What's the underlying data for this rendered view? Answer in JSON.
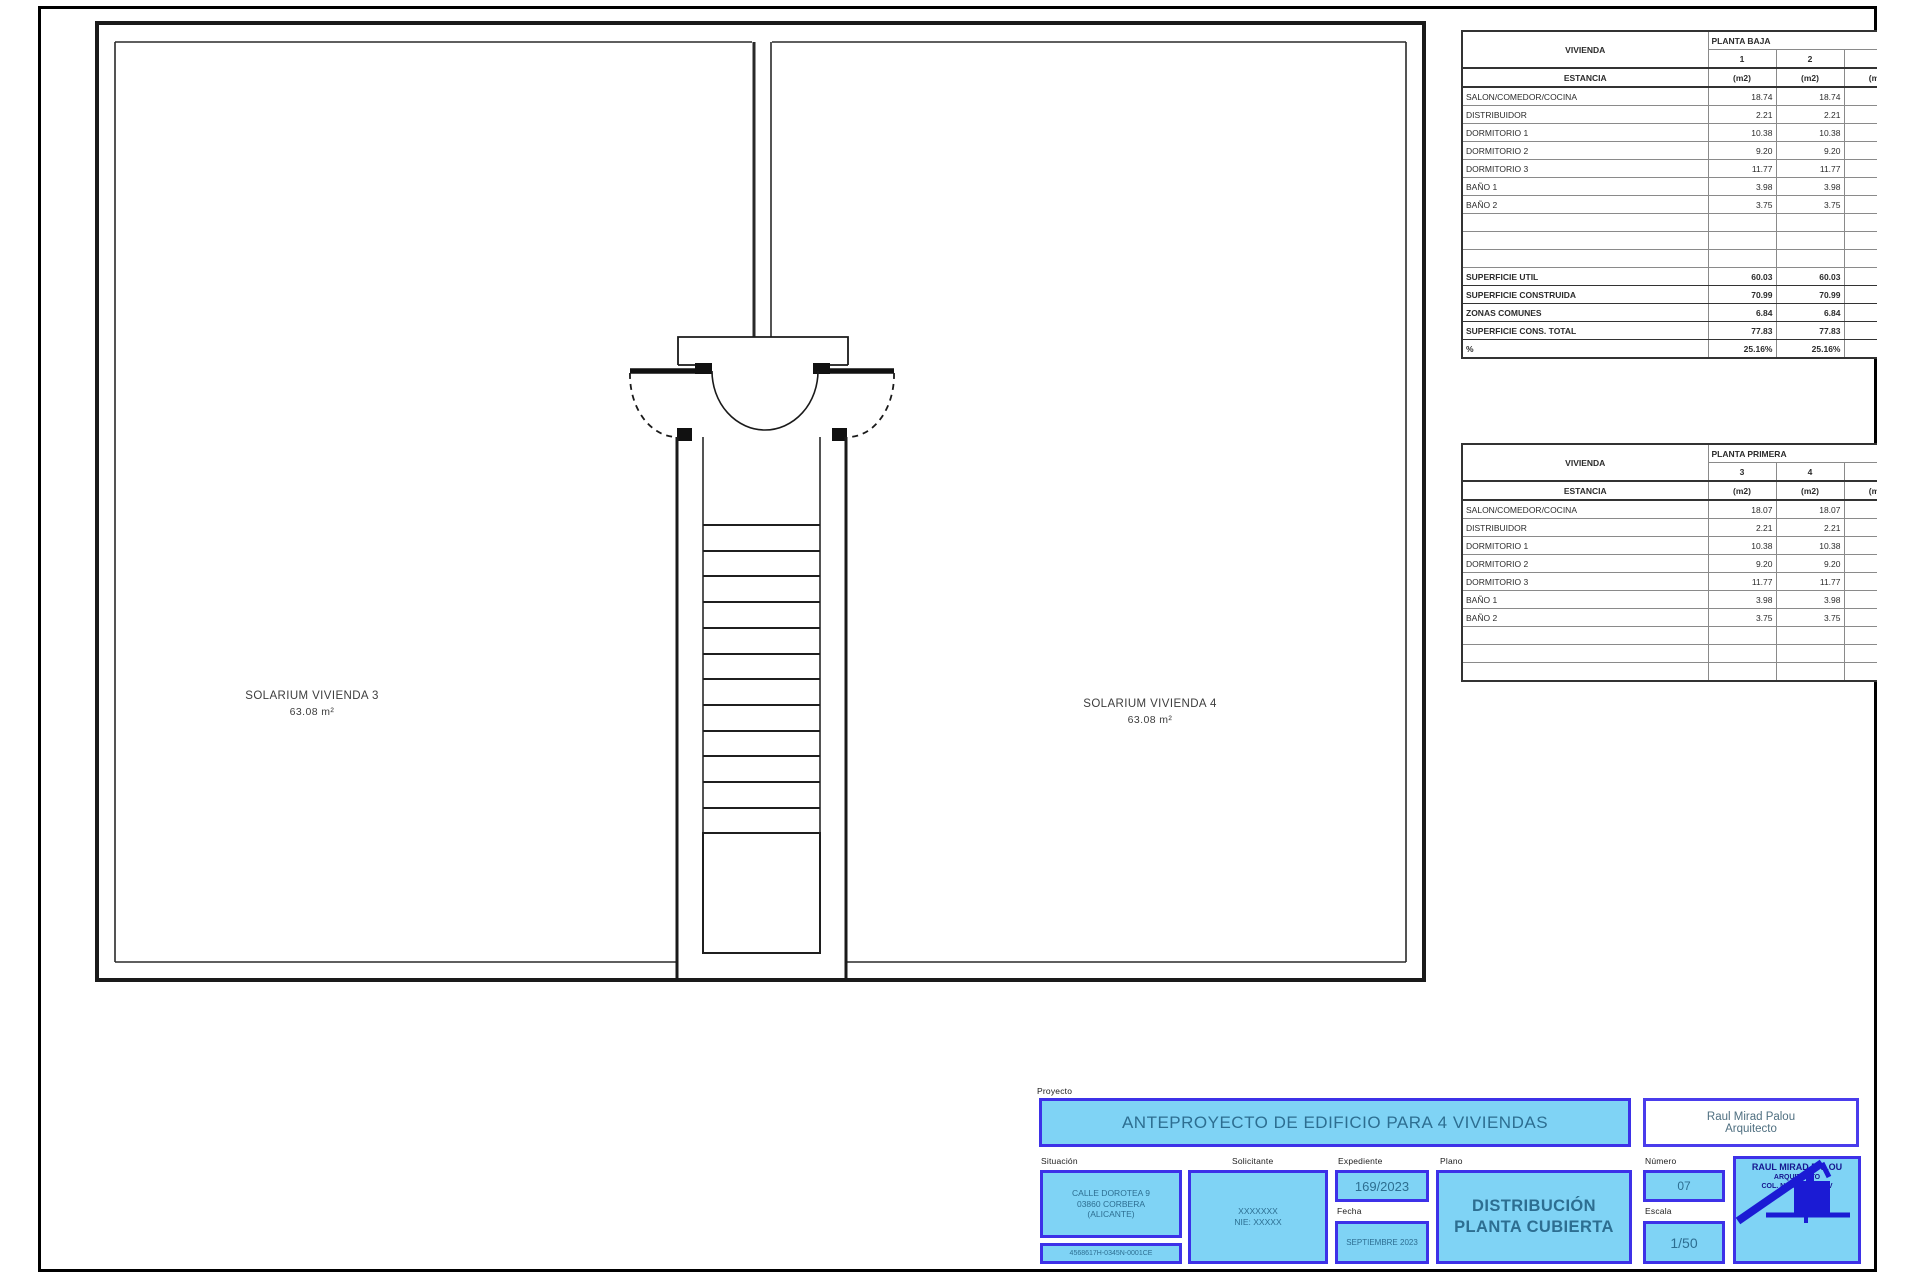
{
  "plan": {
    "room_left": {
      "name": "SOLARIUM VIVIENDA 3",
      "area": "63.08 m²"
    },
    "room_right": {
      "name": "SOLARIUM VIVIENDA 4",
      "area": "63.08 m²"
    }
  },
  "tables": [
    {
      "vivienda_label": "VIVIENDA",
      "floor_label": "PLANTA BAJA",
      "unit_labels": [
        "1",
        "2"
      ],
      "estancia_label": "ESTANCIA",
      "unit_sub": [
        "(m2)",
        "(m2)"
      ],
      "col3_fragment": "(m2)",
      "rows": [
        [
          "SALON/COMEDOR/COCINA",
          "18.74",
          "18.74"
        ],
        [
          "DISTRIBUIDOR",
          "2.21",
          "2.21"
        ],
        [
          "DORMITORIO 1",
          "10.38",
          "10.38"
        ],
        [
          "DORMITORIO 2",
          "9.20",
          "9.20"
        ],
        [
          "DORMITORIO 3",
          "11.77",
          "11.77"
        ],
        [
          "BAÑO 1",
          "3.98",
          "3.98"
        ],
        [
          "BAÑO 2",
          "3.75",
          "3.75"
        ],
        [
          "",
          "",
          ""
        ],
        [
          "",
          "",
          ""
        ],
        [
          "",
          "",
          ""
        ]
      ],
      "summary": [
        [
          "SUPERFICIE UTIL",
          "60.03",
          "60.03"
        ],
        [
          "SUPERFICIE CONSTRUIDA",
          "70.99",
          "70.99"
        ],
        [
          "ZONAS COMUNES",
          "6.84",
          "6.84"
        ],
        [
          "SUPERFICIE CONS. TOTAL",
          "77.83",
          "77.83"
        ],
        [
          "%",
          "25.16%",
          "25.16%"
        ]
      ]
    },
    {
      "vivienda_label": "VIVIENDA",
      "floor_label": "PLANTA PRIMERA",
      "unit_labels": [
        "3",
        "4"
      ],
      "estancia_label": "ESTANCIA",
      "unit_sub": [
        "(m2)",
        "(m2)"
      ],
      "col3_fragment": "(m2)",
      "rows": [
        [
          "SALON/COMEDOR/COCINA",
          "18.07",
          "18.07"
        ],
        [
          "DISTRIBUIDOR",
          "2.21",
          "2.21"
        ],
        [
          "DORMITORIO 1",
          "10.38",
          "10.38"
        ],
        [
          "DORMITORIO 2",
          "9.20",
          "9.20"
        ],
        [
          "DORMITORIO 3",
          "11.77",
          "11.77"
        ],
        [
          "BAÑO 1",
          "3.98",
          "3.98"
        ],
        [
          "BAÑO 2",
          "3.75",
          "3.75"
        ],
        [
          "",
          "",
          ""
        ],
        [
          "",
          "",
          ""
        ],
        [
          "",
          "",
          ""
        ]
      ],
      "summary": []
    }
  ],
  "title_block": {
    "proyecto_label": "Proyecto",
    "project_title": "ANTEPROYECTO DE EDIFICIO PARA 4 VIVIENDAS",
    "architect_name": "Raul Mirad Palou",
    "architect_role": "Arquitecto",
    "situacion_label": "Situación",
    "situacion_line1": "CALLE DOROTEA 9",
    "situacion_line2": "03860 CORBERA",
    "situacion_line3": "(ALICANTE)",
    "ref_catastral": "4568617H-0345N-0001CE",
    "solicitante_label": "Solicitante",
    "solicitante_line1": "XXXXXXX",
    "solicitante_line2": "NIE: XXXXX",
    "expediente_label": "Expediente",
    "expediente_value": "169/2023",
    "fecha_label": "Fecha",
    "fecha_value": "SEPTIEMBRE 2023",
    "plano_label": "Plano",
    "plano_line1": "DISTRIBUCIÓN",
    "plano_line2": "PLANTA CUBIERTA",
    "numero_label": "Número",
    "numero_value": "07",
    "escala_label": "Escala",
    "escala_value": "1/50",
    "stamp_name": "RAUL MIRAD PALOU",
    "stamp_role": "ARQUITECTO",
    "stamp_college": "COL. Nº 1234 COACV"
  },
  "colors": {
    "cyan_fill": "#7fd3f5",
    "blue_border": "#3d31e8",
    "value_text": "#2d6e91",
    "signature_blue": "#1b1bd4",
    "wall_black": "#1a1a1a"
  }
}
